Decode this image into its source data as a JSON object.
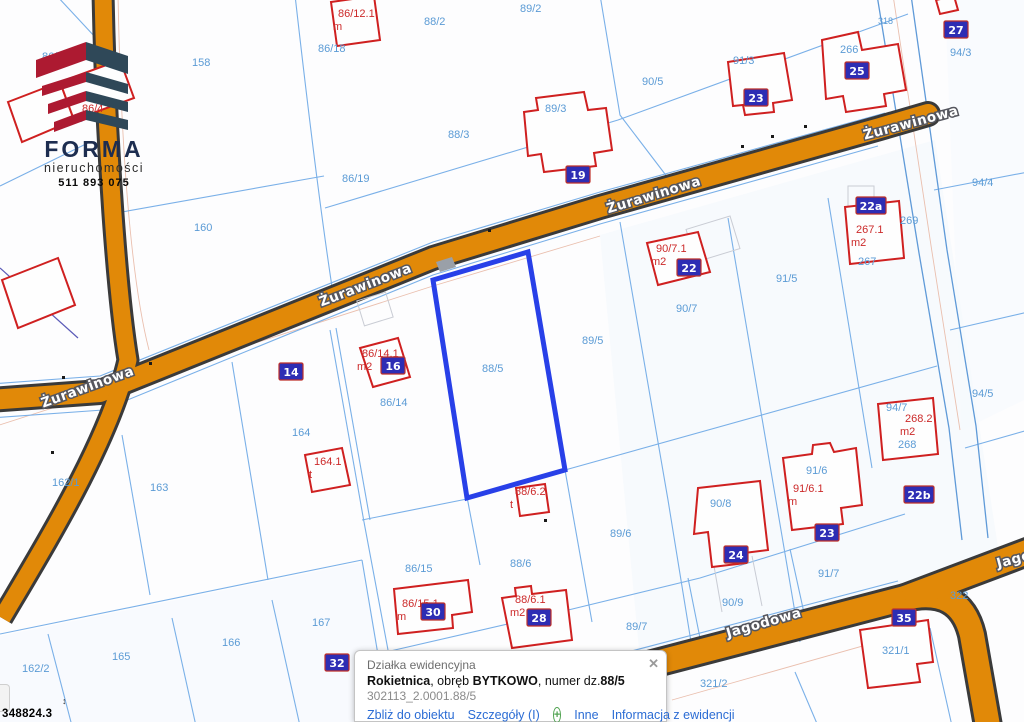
{
  "logo": {
    "brand": "FORMA",
    "subtitle": "nieruchomości",
    "phone": "511 893 075"
  },
  "coordinates": {
    "easting": "348824.3",
    "updown_icon": "↕"
  },
  "streets": {
    "zurawinowa": "Żurawinowa",
    "jagodowa": "Jagodowa"
  },
  "map": {
    "highlighted_parcel": "88/5",
    "parcel_labels": [
      "86/4",
      "9",
      "158",
      "86/18",
      "88/2",
      "89/2",
      "90/5",
      "91/3",
      "266",
      "94/3",
      "318",
      "88/3",
      "89/3",
      "86/19",
      "160",
      "94/4",
      "269",
      "267",
      "91/5",
      "90/7",
      "88/5",
      "89/5",
      "86/14",
      "164",
      "268",
      "162/1",
      "163",
      "90/8",
      "91/6",
      "89/6",
      "86/15",
      "88/6",
      "89/7",
      "90/9",
      "91/7",
      "322",
      "321/1",
      "167",
      "166",
      "165",
      "162/2",
      "321/2",
      "94/5",
      "94/7"
    ],
    "building_labels": [
      {
        "l1": "86/12.1",
        "l2": "m"
      },
      {
        "l1": "86/4",
        "l2": ""
      },
      {
        "l1": "267.1",
        "l2": "m2"
      },
      {
        "l1": "90/7.1",
        "l2": "m2"
      },
      {
        "l1": "86/14.1",
        "l2": "m2"
      },
      {
        "l1": "164.1",
        "l2": "t"
      },
      {
        "l1": "88/6.2",
        "l2": "t"
      },
      {
        "l1": "268.2",
        "l2": "m2"
      },
      {
        "l1": "91/6.1",
        "l2": "m"
      },
      {
        "l1": "86/15.1",
        "l2": "m"
      },
      {
        "l1": "88/6.1",
        "l2": "m2"
      }
    ],
    "house_numbers": [
      "19",
      "23",
      "25",
      "27",
      "22a",
      "22",
      "14",
      "16",
      "24",
      "23",
      "22b",
      "28",
      "30",
      "32",
      "35"
    ]
  },
  "popup": {
    "type_label": "Działka ewidencyjna",
    "municipality": "Rokietnica",
    "sep1": ", obręb ",
    "district": "BYTKOWO",
    "sep2": ", numer dz.",
    "parcel_number": "88/5",
    "full_id": "302113_2.0001.88/5",
    "links": {
      "zoom_to": "Zbliż do obiektu",
      "details": "Szczegóły (I)",
      "other": "Inne",
      "registry_info": "Informacja z ewidencji"
    },
    "plus_icon": "+",
    "close_icon": "✕"
  },
  "colors": {
    "road_fill": "#e18908",
    "road_edge": "#3a3a3a",
    "parcel_line": "#7ab0e8",
    "building_stroke": "#cf2020",
    "highlight": "#2840e8",
    "label_blue": "#5b9bd5",
    "label_red": "#cc2a2a",
    "house_plate_bg": "#2d2db4",
    "link_blue": "#2b6cd4"
  }
}
